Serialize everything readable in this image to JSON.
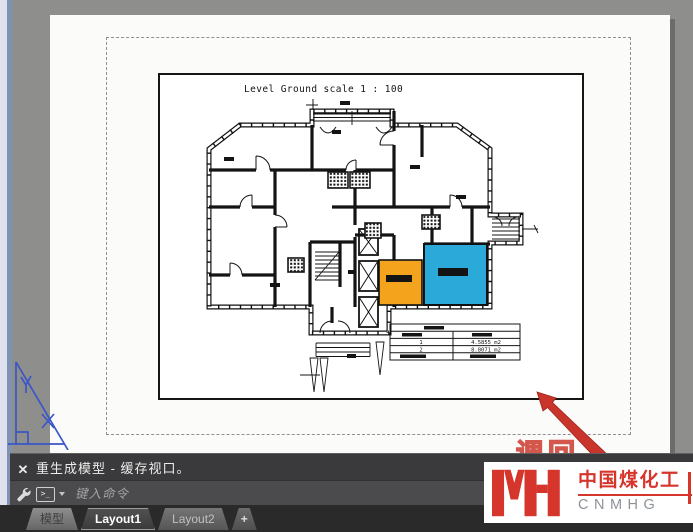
{
  "window": {
    "background": "#8e8e8c",
    "paper_color": "#fbfbfa"
  },
  "viewport": {
    "title": "Level Ground  scale 1 : 100",
    "room_colors": {
      "orange": "#F4A41C",
      "cyan": "#2BA9D8"
    },
    "area_table": {
      "rows": [
        {
          "no": "1",
          "area": "4.5855 m2"
        },
        {
          "no": "2",
          "area": "8.8071 m2"
        }
      ]
    }
  },
  "command_panel": {
    "close_label": "✕",
    "history_line": "重生成模型 - 缓存视口。",
    "prompt_symbol": ">_",
    "input_placeholder": "键入命令"
  },
  "tab_bar": {
    "active": "Layout1",
    "tabs": [
      {
        "label": "模型"
      },
      {
        "label": "Layout1"
      },
      {
        "label": "Layout2"
      },
      {
        "label": "+"
      }
    ]
  },
  "watermark": {
    "outline_text": "调回",
    "brand_cn": "中国煤化工",
    "brand_en": "CNMHG",
    "brand_color": "#d6352c"
  },
  "colors": {
    "arrow_red": "#c9352b",
    "ucs_blue": "#3a56c8"
  }
}
